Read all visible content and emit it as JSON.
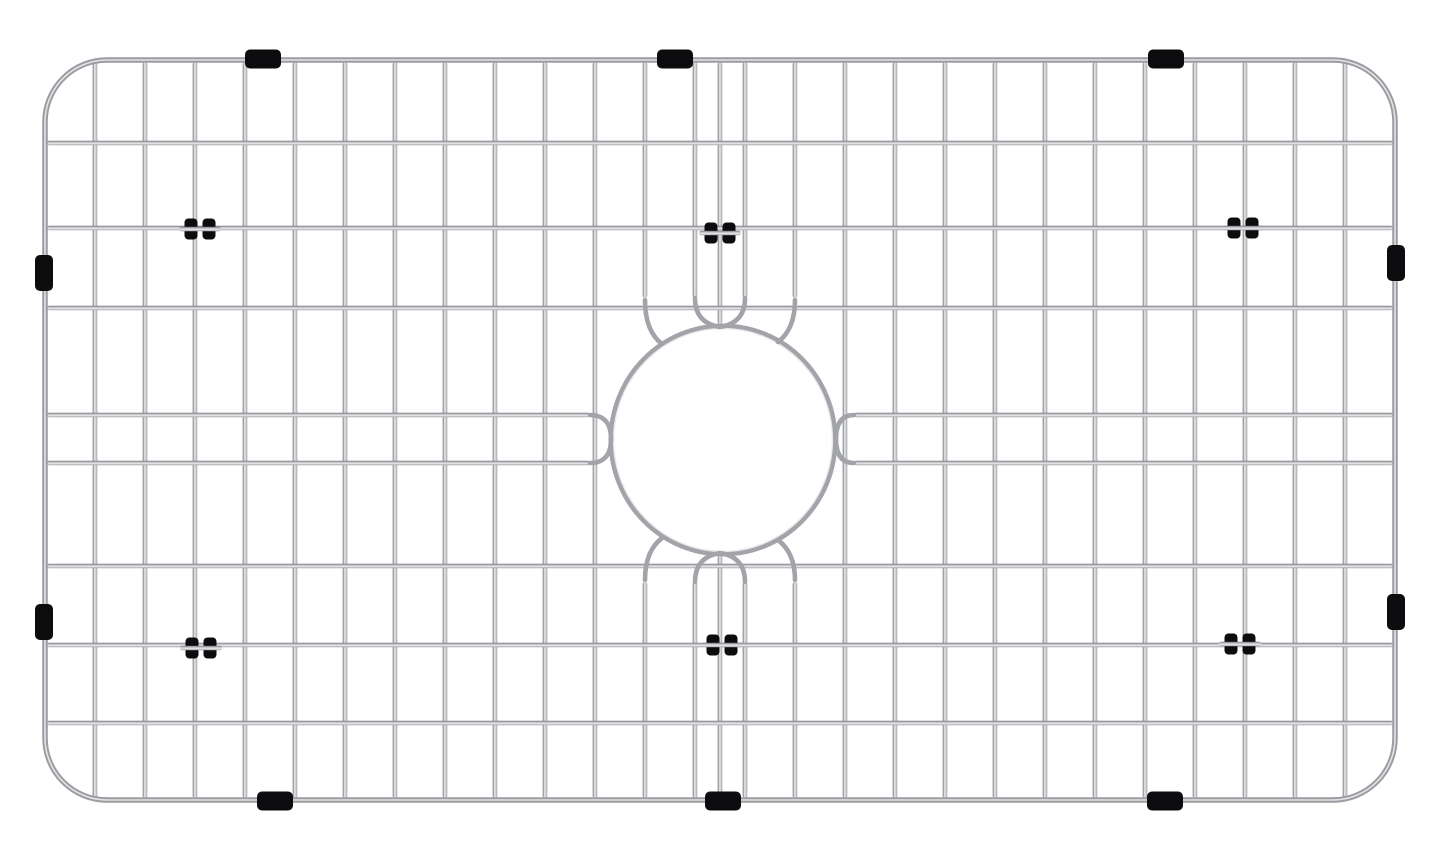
{
  "scene": {
    "description": "Product photograph of a stainless steel kitchen sink bottom grid (sink protector) with a circular drain opening in the center, black rubber edge bumpers and black wire clips, on a white background",
    "background_color": "#ffffff"
  },
  "canvas": {
    "width": 1445,
    "height": 860
  },
  "colors": {
    "background": "#ffffff",
    "wire_mid": "#a2a4a9",
    "wire_dark": "#74767b",
    "wire_light": "#e9eaec",
    "frame_mid": "#9a9ca1",
    "frame_highlight": "#e2e3e5",
    "rubber_black": "#0c0c0e"
  },
  "grid": {
    "frame": {
      "x": 45,
      "y": 60,
      "width": 1350,
      "height": 740,
      "corner_radius": 62,
      "stroke_width": 5.5
    },
    "wire_width": 4.6,
    "wires": {
      "vertical_xs": [
        95,
        145,
        195,
        245,
        295,
        345,
        395,
        445,
        495,
        545,
        595,
        645,
        695,
        745,
        795,
        845,
        895,
        945,
        995,
        1045,
        1095,
        1145,
        1195,
        1245,
        1295,
        1345
      ],
      "interrupted_vertical_xs": [
        645,
        695,
        745,
        795
      ],
      "interrupted_top_end_y": 298,
      "interrupted_bottom_start_y": 582,
      "center_wire": {
        "x": 720,
        "top_end_y": 324,
        "bottom_start_y": 556
      },
      "horizontal_full_ys": [
        143,
        228,
        308,
        566,
        645,
        723
      ],
      "horizontal_pair_ys": [
        415,
        463
      ],
      "pair_left_end_x": 590,
      "pair_right_start_x": 854,
      "h_span": {
        "x1": 47,
        "x2": 1393
      },
      "v_span": {
        "y1": 62,
        "y2": 798
      }
    },
    "drain": {
      "cx": 723,
      "cy": 440,
      "rx": 112,
      "ry": 114,
      "ring_stroke_width": 5,
      "detail_paths": [
        "M645,300 Q645,331 662,344",
        "M795,300 Q795,329 778,342",
        "M645,580 Q645,551 662,538",
        "M795,580 Q795,553 778,540",
        "M695,298 Q695,323 720,327 Q745,323 745,298",
        "M695,582 Q695,557 720,553 Q745,557 745,582",
        "M590,415 Q611,415 611,439 Q611,463 590,463",
        "M854,415 Q836,415 836,439 Q836,463 854,463"
      ]
    },
    "bumpers": {
      "top_center_xs": [
        263,
        675,
        1166
      ],
      "bottom_center_xs": [
        275,
        723,
        1165
      ],
      "left_center_ys": [
        273,
        622
      ],
      "right_center_ys": [
        263,
        612
      ],
      "horizontal_size": {
        "w": 36,
        "h": 19
      },
      "vertical_size": {
        "w": 18,
        "h": 36
      }
    },
    "clips": [
      {
        "x": 200,
        "y": 229
      },
      {
        "x": 720,
        "y": 233
      },
      {
        "x": 1243,
        "y": 228
      },
      {
        "x": 201,
        "y": 648
      },
      {
        "x": 722,
        "y": 645
      },
      {
        "x": 1240,
        "y": 644
      }
    ],
    "clip_size": {
      "lobe_w": 13,
      "h": 21,
      "gap": 5,
      "wire_overhang": 21
    }
  }
}
